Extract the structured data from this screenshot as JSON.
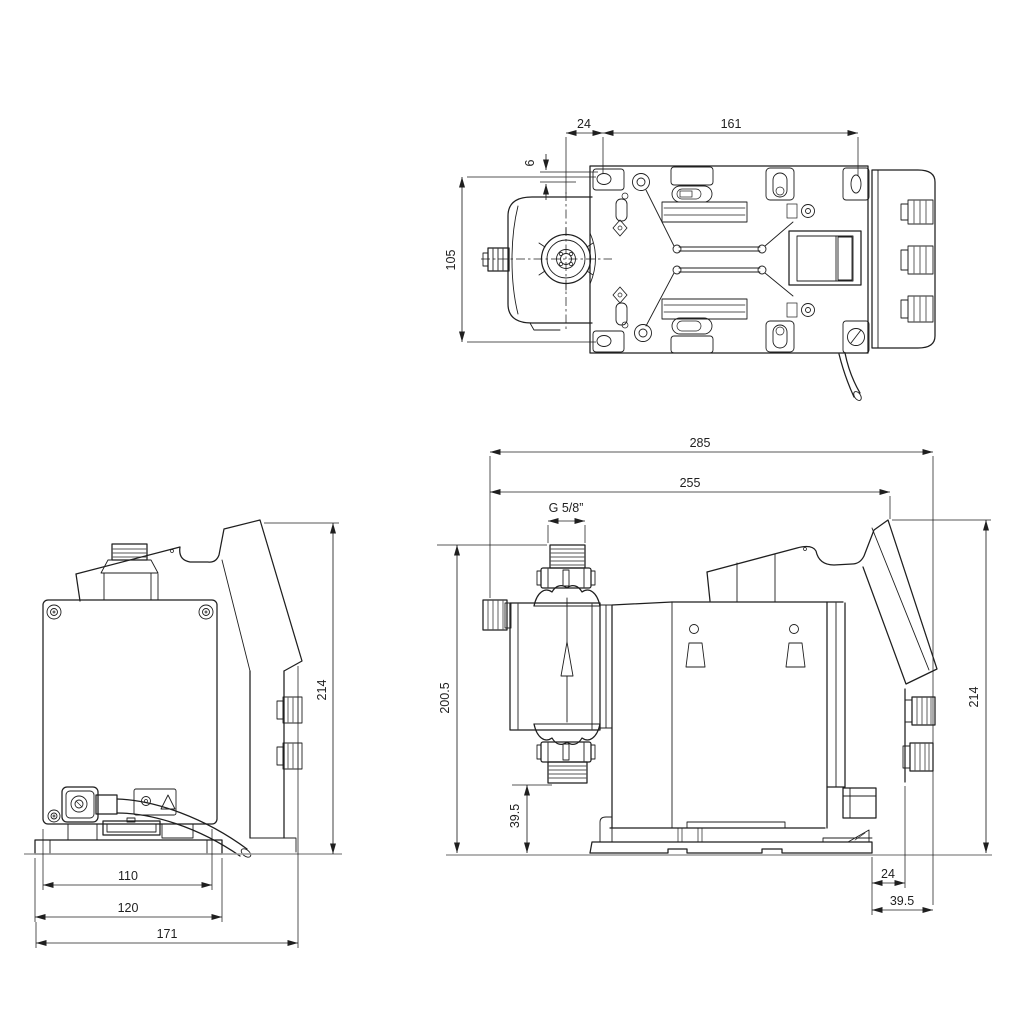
{
  "app": {
    "background_color": "#ffffff",
    "line_color": "#1f1f1f"
  },
  "views": {
    "top": {
      "dims": {
        "offset_24": "24",
        "hole_span_161": "161",
        "edge_offset_6": "6",
        "height_105": "105"
      }
    },
    "rear": {
      "dims": {
        "height_214": "214",
        "plate_width_110": "110",
        "base_width_120": "120",
        "depth_171": "171"
      }
    },
    "side": {
      "dims": {
        "length_285": "285",
        "length_255": "255",
        "thread_size": "G 5/8”",
        "height_200_5": "200.5",
        "port_height_39_5": "39.5",
        "height_214": "214",
        "base_offset_24": "24",
        "overhang_39_5": "39.5"
      }
    }
  }
}
